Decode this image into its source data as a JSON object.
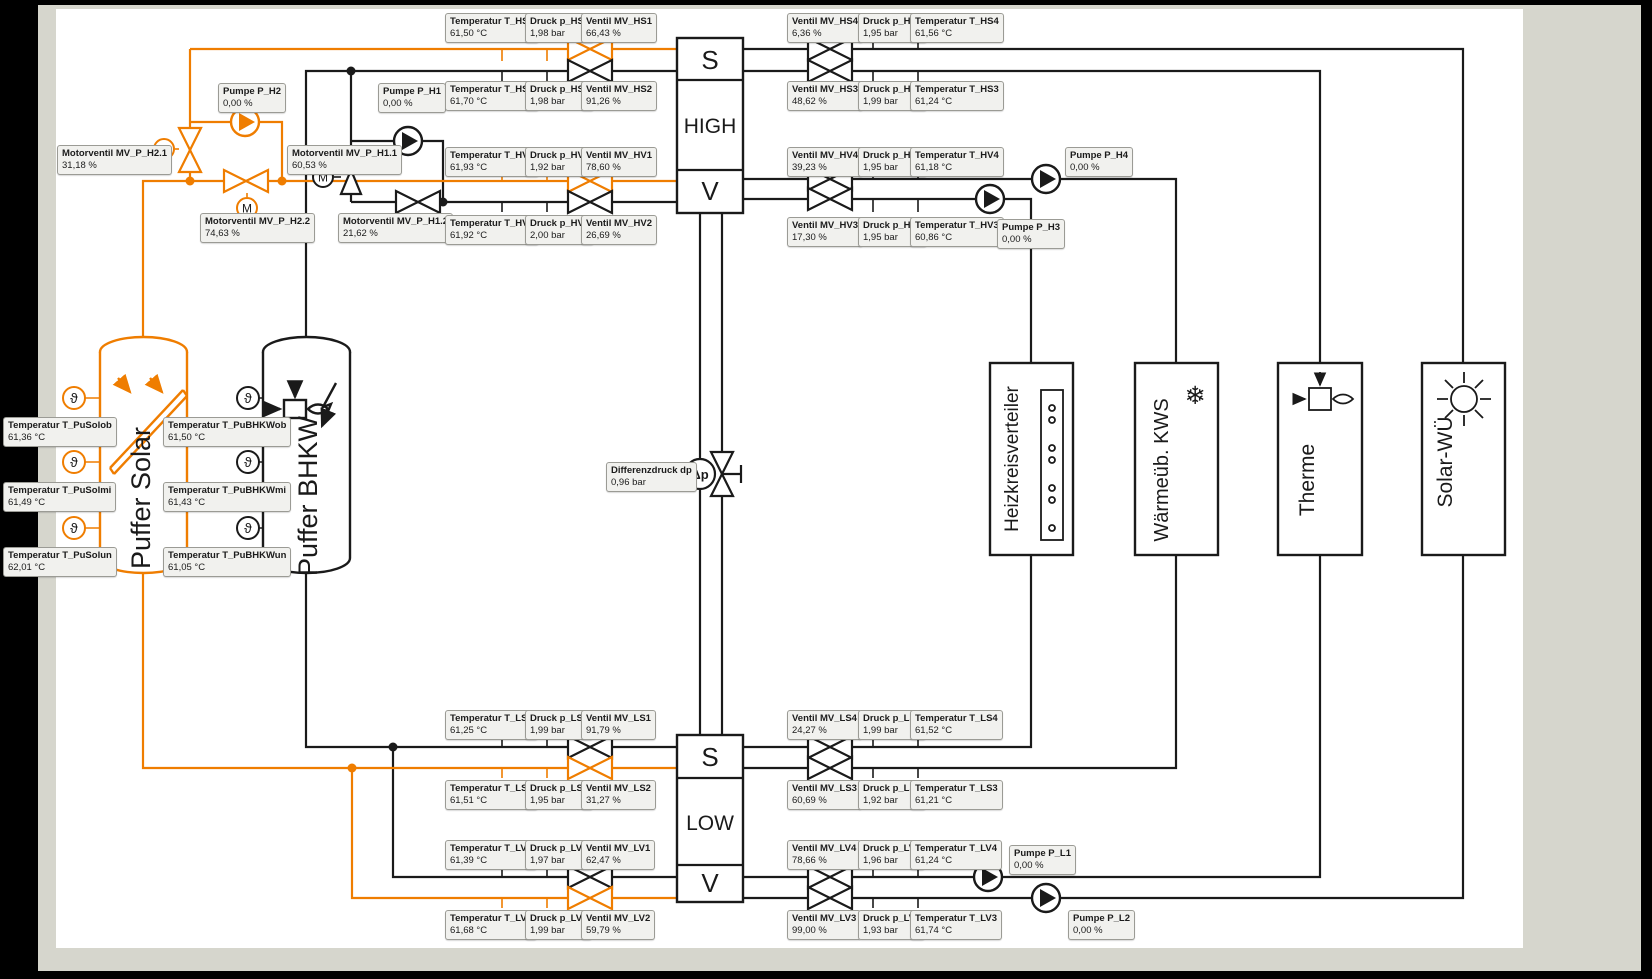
{
  "colors": {
    "orange": "#ef7d00",
    "line": "#1a1a1a",
    "label_bg": "#f1f1ee",
    "canvas": "#ffffff",
    "frame": "#d6d6cd"
  },
  "headers": {
    "top": {
      "s": "S",
      "mid": "HIGH",
      "v": "V"
    },
    "bottom": {
      "s": "S",
      "mid": "LOW",
      "v": "V"
    }
  },
  "equipment": {
    "puffer_solar": "Puffer Solar",
    "puffer_bhkw": "Puffer BHKW",
    "heizkreisverteiler": "Heizkreisverteiler",
    "waermeueb": "Wärmeüb. KWS",
    "therme": "Therme",
    "solar_wue": "Solar-WÜ"
  },
  "symbols": {
    "theta": "ϑ",
    "motor": "M",
    "dp": "Δp",
    "snowflake": "❄"
  },
  "labels": {
    "T_HS1": {
      "name": "Temperatur T_HS1",
      "value": "61,50 °C"
    },
    "p_HS1": {
      "name": "Druck p_HS1",
      "value": "1,98 bar"
    },
    "MV_HS1": {
      "name": "Ventil MV_HS1",
      "value": "66,43 %"
    },
    "T_HS2": {
      "name": "Temperatur T_HS2",
      "value": "61,70 °C"
    },
    "p_HS2": {
      "name": "Druck p_HS2",
      "value": "1,98 bar"
    },
    "MV_HS2": {
      "name": "Ventil MV_HS2",
      "value": "91,26 %"
    },
    "P_H1": {
      "name": "Pumpe P_H1",
      "value": "0,00 %"
    },
    "P_H2": {
      "name": "Pumpe P_H2",
      "value": "0,00 %"
    },
    "MV_P_H21": {
      "name": "Motorventil MV_P_H2.1",
      "value": "31,18 %"
    },
    "MV_P_H22": {
      "name": "Motorventil MV_P_H2.2",
      "value": "74,63 %"
    },
    "MV_P_H11": {
      "name": "Motorventil MV_P_H1.1",
      "value": "60,53 %"
    },
    "MV_P_H12": {
      "name": "Motorventil MV_P_H1.2",
      "value": "21,62 %"
    },
    "T_HV1": {
      "name": "Temperatur T_HV1",
      "value": "61,93 °C"
    },
    "p_HV1": {
      "name": "Druck p_HV1",
      "value": "1,92 bar"
    },
    "MV_HV1": {
      "name": "Ventil MV_HV1",
      "value": "78,60 %"
    },
    "T_HV2": {
      "name": "Temperatur T_HV2",
      "value": "61,92 °C"
    },
    "p_HV2": {
      "name": "Druck p_HV2",
      "value": "2,00 bar"
    },
    "MV_HV2": {
      "name": "Ventil MV_HV2",
      "value": "26,69 %"
    },
    "MV_HS4": {
      "name": "Ventil MV_HS4",
      "value": "6,36 %"
    },
    "p_HS4": {
      "name": "Druck p_HS4",
      "value": "1,95 bar"
    },
    "T_HS4": {
      "name": "Temperatur T_HS4",
      "value": "61,56 °C"
    },
    "MV_HS3": {
      "name": "Ventil MV_HS3",
      "value": "48,62 %"
    },
    "p_HS3": {
      "name": "Druck p_HS3",
      "value": "1,99 bar"
    },
    "T_HS3": {
      "name": "Temperatur T_HS3",
      "value": "61,24 °C"
    },
    "MV_HV4": {
      "name": "Ventil MV_HV4",
      "value": "39,23 %"
    },
    "p_HV4": {
      "name": "Druck p_HV4",
      "value": "1,95 bar"
    },
    "T_HV4": {
      "name": "Temperatur T_HV4",
      "value": "61,18 °C"
    },
    "P_H4": {
      "name": "Pumpe P_H4",
      "value": "0,00 %"
    },
    "MV_HV3": {
      "name": "Ventil MV_HV3",
      "value": "17,30 %"
    },
    "p_HV3": {
      "name": "Druck p_HV3",
      "value": "1,95 bar"
    },
    "T_HV3": {
      "name": "Temperatur T_HV3",
      "value": "60,86 °C"
    },
    "P_H3": {
      "name": "Pumpe P_H3",
      "value": "0,00 %"
    },
    "dp": {
      "name": "Differenzdruck dp",
      "value": "0,96 bar"
    },
    "T_PuSolob": {
      "name": "Temperatur T_PuSolob",
      "value": "61,36 °C"
    },
    "T_PuSolmi": {
      "name": "Temperatur T_PuSolmi",
      "value": "61,49 °C"
    },
    "T_PuSolun": {
      "name": "Temperatur T_PuSolun",
      "value": "62,01 °C"
    },
    "T_PuBHKWob": {
      "name": "Temperatur T_PuBHKWob",
      "value": "61,50 °C"
    },
    "T_PuBHKWmi": {
      "name": "Temperatur T_PuBHKWmi",
      "value": "61,43 °C"
    },
    "T_PuBHKWun": {
      "name": "Temperatur T_PuBHKWun",
      "value": "61,05 °C"
    },
    "T_LS1": {
      "name": "Temperatur T_LS1",
      "value": "61,25 °C"
    },
    "p_LS1": {
      "name": "Druck p_LS1",
      "value": "1,99 bar"
    },
    "MV_LS1": {
      "name": "Ventil MV_LS1",
      "value": "91,79 %"
    },
    "T_LS2": {
      "name": "Temperatur T_LS2",
      "value": "61,51 °C"
    },
    "p_LS2": {
      "name": "Druck p_LS2",
      "value": "1,95 bar"
    },
    "MV_LS2": {
      "name": "Ventil MV_LS2",
      "value": "31,27 %"
    },
    "T_LV1": {
      "name": "Temperatur T_LV1",
      "value": "61,39 °C"
    },
    "p_LV1": {
      "name": "Druck p_LV1",
      "value": "1,97 bar"
    },
    "MV_LV1": {
      "name": "Ventil MV_LV1",
      "value": "62,47 %"
    },
    "T_LV2": {
      "name": "Temperatur T_LV2",
      "value": "61,68 °C"
    },
    "p_LV2": {
      "name": "Druck p_LV2",
      "value": "1,99 bar"
    },
    "MV_LV2": {
      "name": "Ventil MV_LV2",
      "value": "59,79 %"
    },
    "MV_LS4": {
      "name": "Ventil MV_LS4",
      "value": "24,27 %"
    },
    "p_LS4": {
      "name": "Druck p_LS4",
      "value": "1,99 bar"
    },
    "T_LS4": {
      "name": "Temperatur T_LS4",
      "value": "61,52 °C"
    },
    "MV_LS3": {
      "name": "Ventil MV_LS3",
      "value": "60,69 %"
    },
    "p_LS3": {
      "name": "Druck p_LS3",
      "value": "1,92 bar"
    },
    "T_LS3": {
      "name": "Temperatur T_LS3",
      "value": "61,21 °C"
    },
    "MV_LV4": {
      "name": "Ventil MV_LV4",
      "value": "78,66 %"
    },
    "p_LV4": {
      "name": "Druck p_LV4",
      "value": "1,96 bar"
    },
    "T_LV4": {
      "name": "Temperatur T_LV4",
      "value": "61,24 °C"
    },
    "P_L1": {
      "name": "Pumpe P_L1",
      "value": "0,00 %"
    },
    "MV_LV3": {
      "name": "Ventil MV_LV3",
      "value": "99,00 %"
    },
    "p_LV3": {
      "name": "Druck p_LV3",
      "value": "1,93 bar"
    },
    "T_LV3": {
      "name": "Temperatur T_LV3",
      "value": "61,74 °C"
    },
    "P_L2": {
      "name": "Pumpe P_L2",
      "value": "0,00 %"
    }
  }
}
